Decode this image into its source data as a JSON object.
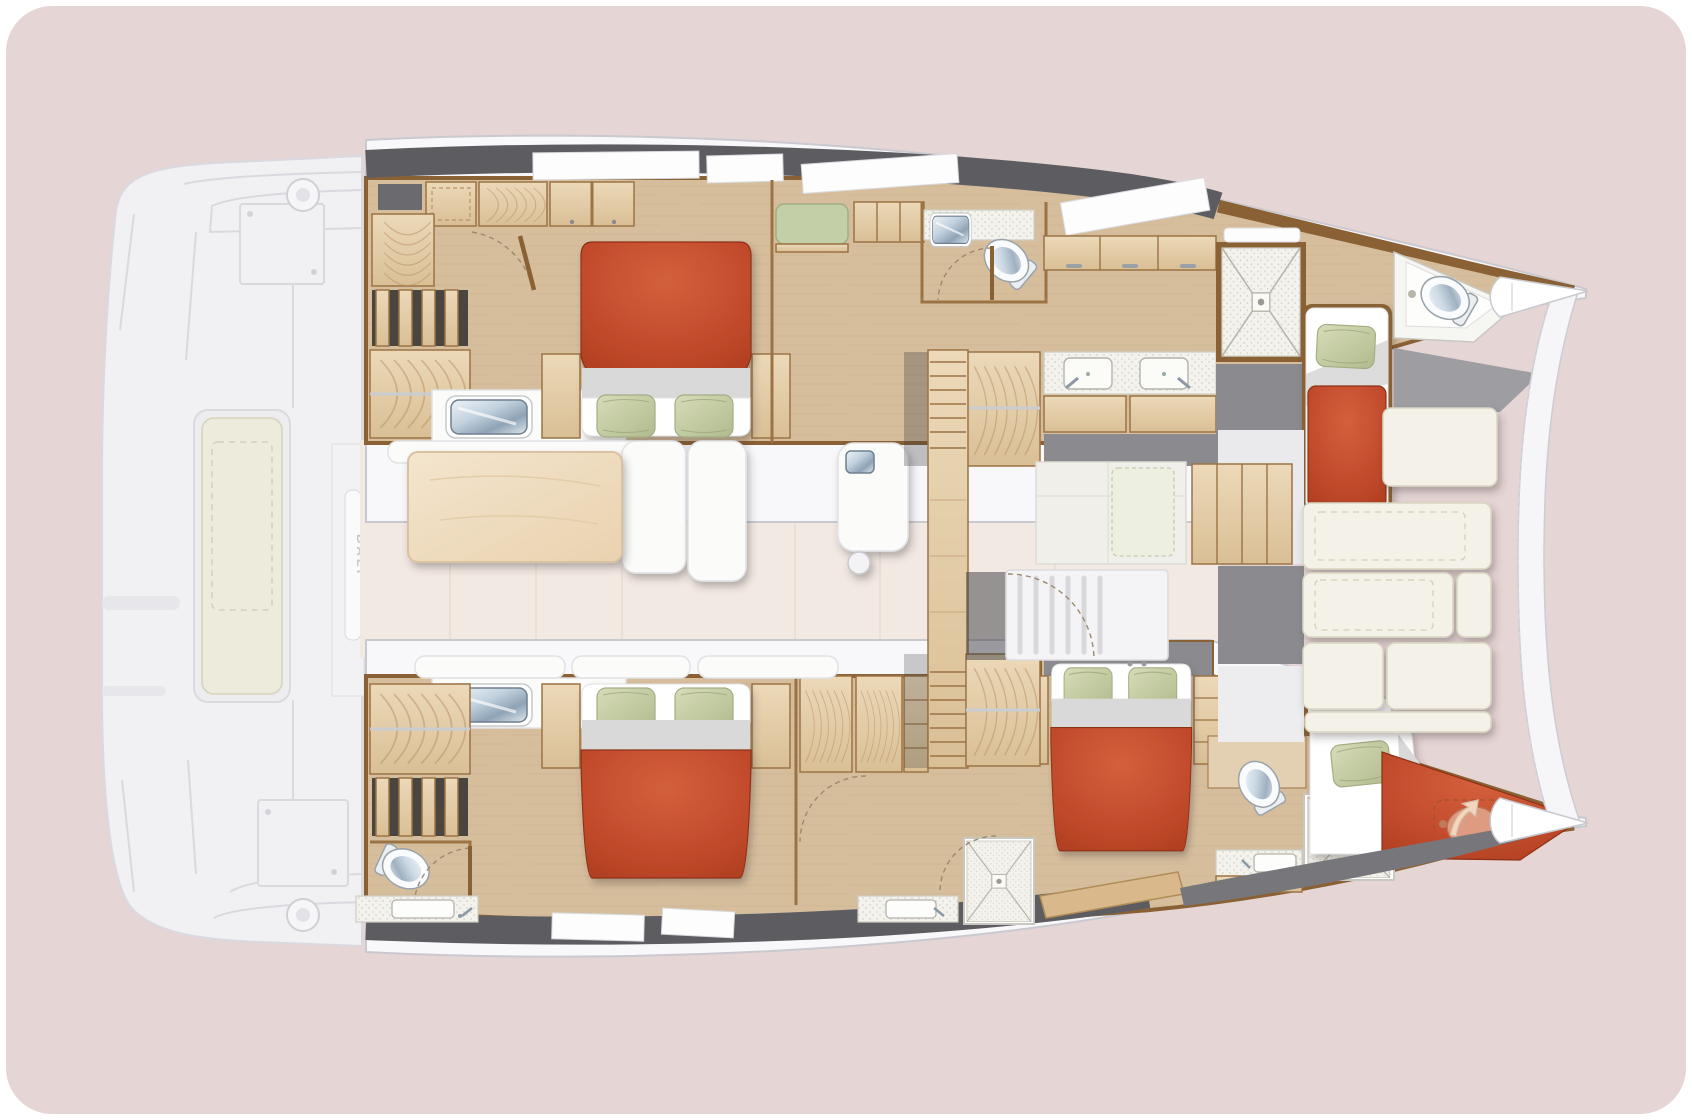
{
  "branding": {
    "hull_label": "BALI"
  },
  "palette": {
    "bg": "#e6d5d5",
    "hull-white": "#f8f8fa",
    "hull-stroke": "#c9c9cf",
    "ghost-base": "#f1f1f4",
    "ghost-line": "#d9d9e0",
    "ghost-dark": "#e6e6eb",
    "gunwale": "#5d5d61",
    "window-white": "#fdfdfe",
    "wall-brown": "#8a6134",
    "trim": "#9b7345",
    "wood-floor": "#d6be9d",
    "wood-floor-light": "#e3d0b2",
    "wood-cabinet": "#e2cba5",
    "wood-grain": "#b89468",
    "salon-floor": "#f2e9e2",
    "gray-floor": "#8b8b8f",
    "gray-dark": "#77777b",
    "bed-red": "#c14a2c",
    "sheet-gray": "#d9d9d9",
    "pillow-green": "#c6cfa8",
    "pillow-edge": "#a3ad83",
    "settee-green": "#c3cfa6",
    "lounge-cushion": "#f4f2e8",
    "cushion-seam": "#b9946a",
    "steel-blue": "#9fb4c7",
    "arrow-cream": "#f2d7bf"
  },
  "areas": [
    {
      "id": "aft-deck",
      "label": "aft-deck-cockpit"
    },
    {
      "id": "salon",
      "label": "salon-dinette-galley"
    },
    {
      "id": "port-hull-aft-cabin",
      "label": "double-cabin-aft-port"
    },
    {
      "id": "port-hull-bathroom",
      "label": "bathroom-midship-port"
    },
    {
      "id": "port-hull-vanity",
      "label": "double-vanity-forward-port"
    },
    {
      "id": "port-hull-shower",
      "label": "shower-forward-port"
    },
    {
      "id": "port-forward-cabin",
      "label": "single-berth-bow-port"
    },
    {
      "id": "starboard-hull-aft-cabin",
      "label": "double-cabin-aft-starboard"
    },
    {
      "id": "starboard-hull-mid-cabin",
      "label": "double-cabin-mid-starboard"
    },
    {
      "id": "starboard-forward-cabin",
      "label": "single-berth-bow-starboard"
    },
    {
      "id": "forepeak-berth",
      "label": "forepeak-crew-berth"
    },
    {
      "id": "forward-lounge",
      "label": "forward-cockpit-sunpads"
    }
  ],
  "furniture_icons": [
    "double-bed-icon",
    "single-berth-icon",
    "pillow-icon",
    "toilet-icon",
    "shower-icon",
    "steel-sink-icon",
    "twin-sink-vanity-icon",
    "hanging-locker-icon",
    "stairs-icon",
    "dinette-table-icon",
    "sofa-icon",
    "fridge-icon",
    "winch-icon",
    "bench-seat-icon",
    "door-swing-icon",
    "bow-arrow-icon"
  ]
}
